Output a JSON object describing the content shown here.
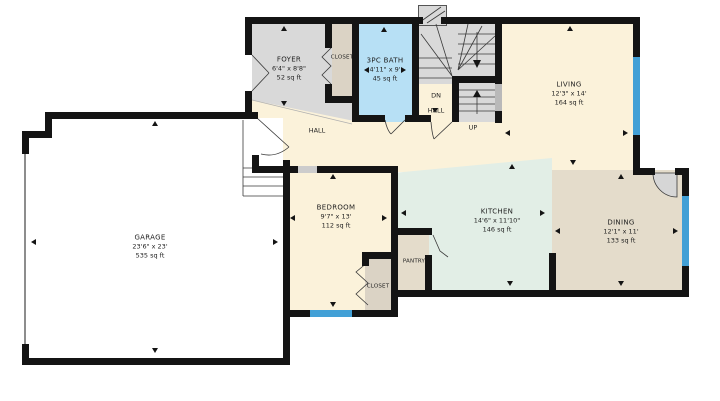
{
  "colors": {
    "wall": "#141414",
    "window": "#42a0d6",
    "floor_cream": "#fbf2da",
    "floor_gray": "#d9d9d9",
    "floor_blue": "#b7e0f5",
    "floor_mint": "#e2eee6",
    "floor_tan": "#e4dccb",
    "floor_closet": "#dbd3c5",
    "niche": "#b9b9b9",
    "door_gap": "#cccccc",
    "garage_door_line": "#8d8d8d",
    "label": "#1f1f1f"
  },
  "rooms": {
    "foyer": {
      "name": "FOYER",
      "dims": "6'4\" x 8'8\"",
      "area": "52 sq ft"
    },
    "bath": {
      "name": "3PC BATH",
      "dims": "4'11\" x 9'",
      "area": "45 sq ft"
    },
    "living": {
      "name": "LIVING",
      "dims": "12'3\" x 14'",
      "area": "164 sq ft"
    },
    "garage": {
      "name": "GARAGE",
      "dims": "23'6\" x 23'",
      "area": "535 sq ft"
    },
    "bedroom": {
      "name": "BEDROOM",
      "dims": "9'7\" x 13'",
      "area": "112 sq ft"
    },
    "kitchen": {
      "name": "KITCHEN",
      "dims": "14'6\" x 11'10\"",
      "area": "146 sq ft"
    },
    "dining": {
      "name": "DINING",
      "dims": "12'1\" x 11'",
      "area": "133 sq ft"
    },
    "foyer_closet": {
      "name": "CLOSET"
    },
    "bedroom_closet": {
      "name": "CLOSET"
    },
    "pantry": {
      "name": "PANTRY"
    }
  },
  "labels": {
    "hall": "HALL",
    "stair_dn": "DN",
    "stair_hall": "HALL",
    "stair_up": "UP"
  }
}
